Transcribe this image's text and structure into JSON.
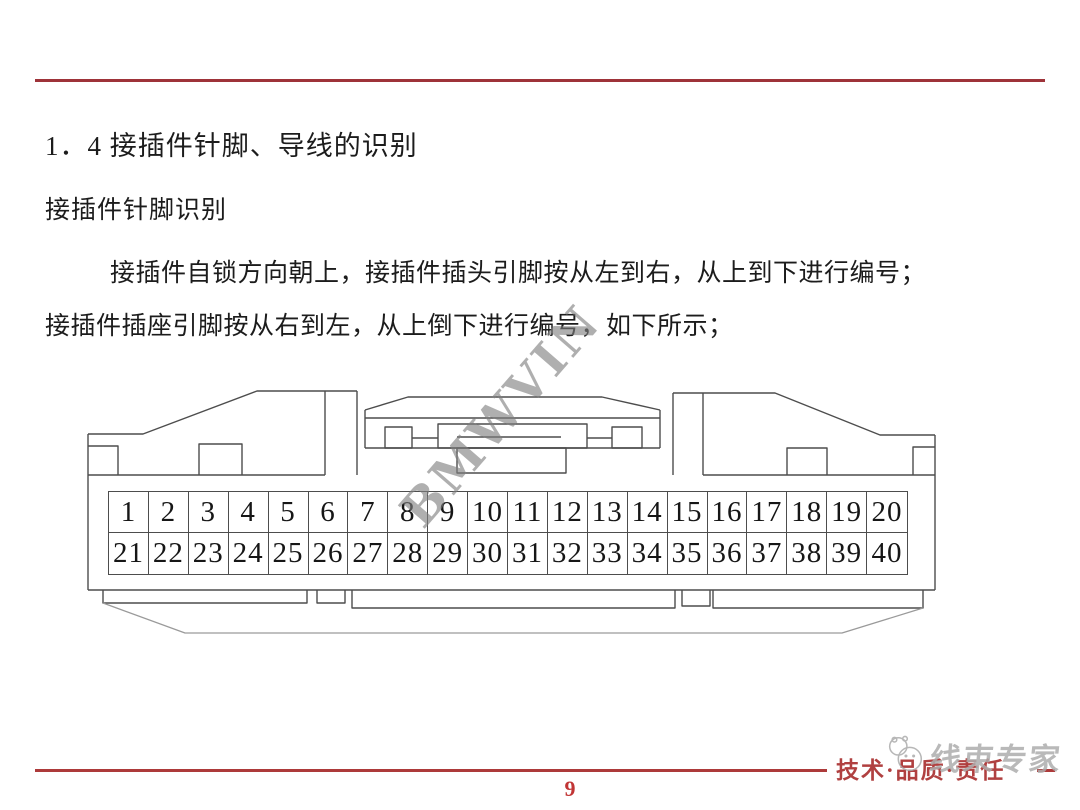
{
  "content": {
    "heading": "1．4 接插件针脚、导线的识别",
    "subheading": "接插件针脚识别",
    "paragraph_line1": "接插件自锁方向朝上，接插件插头引脚按从左到右，从上到下进行编号；",
    "paragraph_line2": "接插件插座引脚按从右到左，从上倒下进行编号，如下所示；"
  },
  "watermark": {
    "text": "BMWVIN",
    "color": "#7f7f7f"
  },
  "diagram": {
    "description": "40-pin connector front view, pins numbered left-to-right, top-to-bottom",
    "pins_top": [
      "1",
      "2",
      "3",
      "4",
      "5",
      "6",
      "7",
      "8",
      "9",
      "10",
      "11",
      "12",
      "13",
      "14",
      "15",
      "16",
      "17",
      "18",
      "19",
      "20"
    ],
    "pins_bottom": [
      "21",
      "22",
      "23",
      "24",
      "25",
      "26",
      "27",
      "28",
      "29",
      "30",
      "31",
      "32",
      "33",
      "34",
      "35",
      "36",
      "37",
      "38",
      "39",
      "40"
    ]
  },
  "footer": {
    "tagline": "技术·品质·责任",
    "brand": "线束专家",
    "page_number": "9"
  },
  "colors": {
    "rule_red": "#9e3339",
    "footer_red": "#b04040",
    "page_number_red": "#c13535",
    "line_gray": "#4d4d4d"
  }
}
